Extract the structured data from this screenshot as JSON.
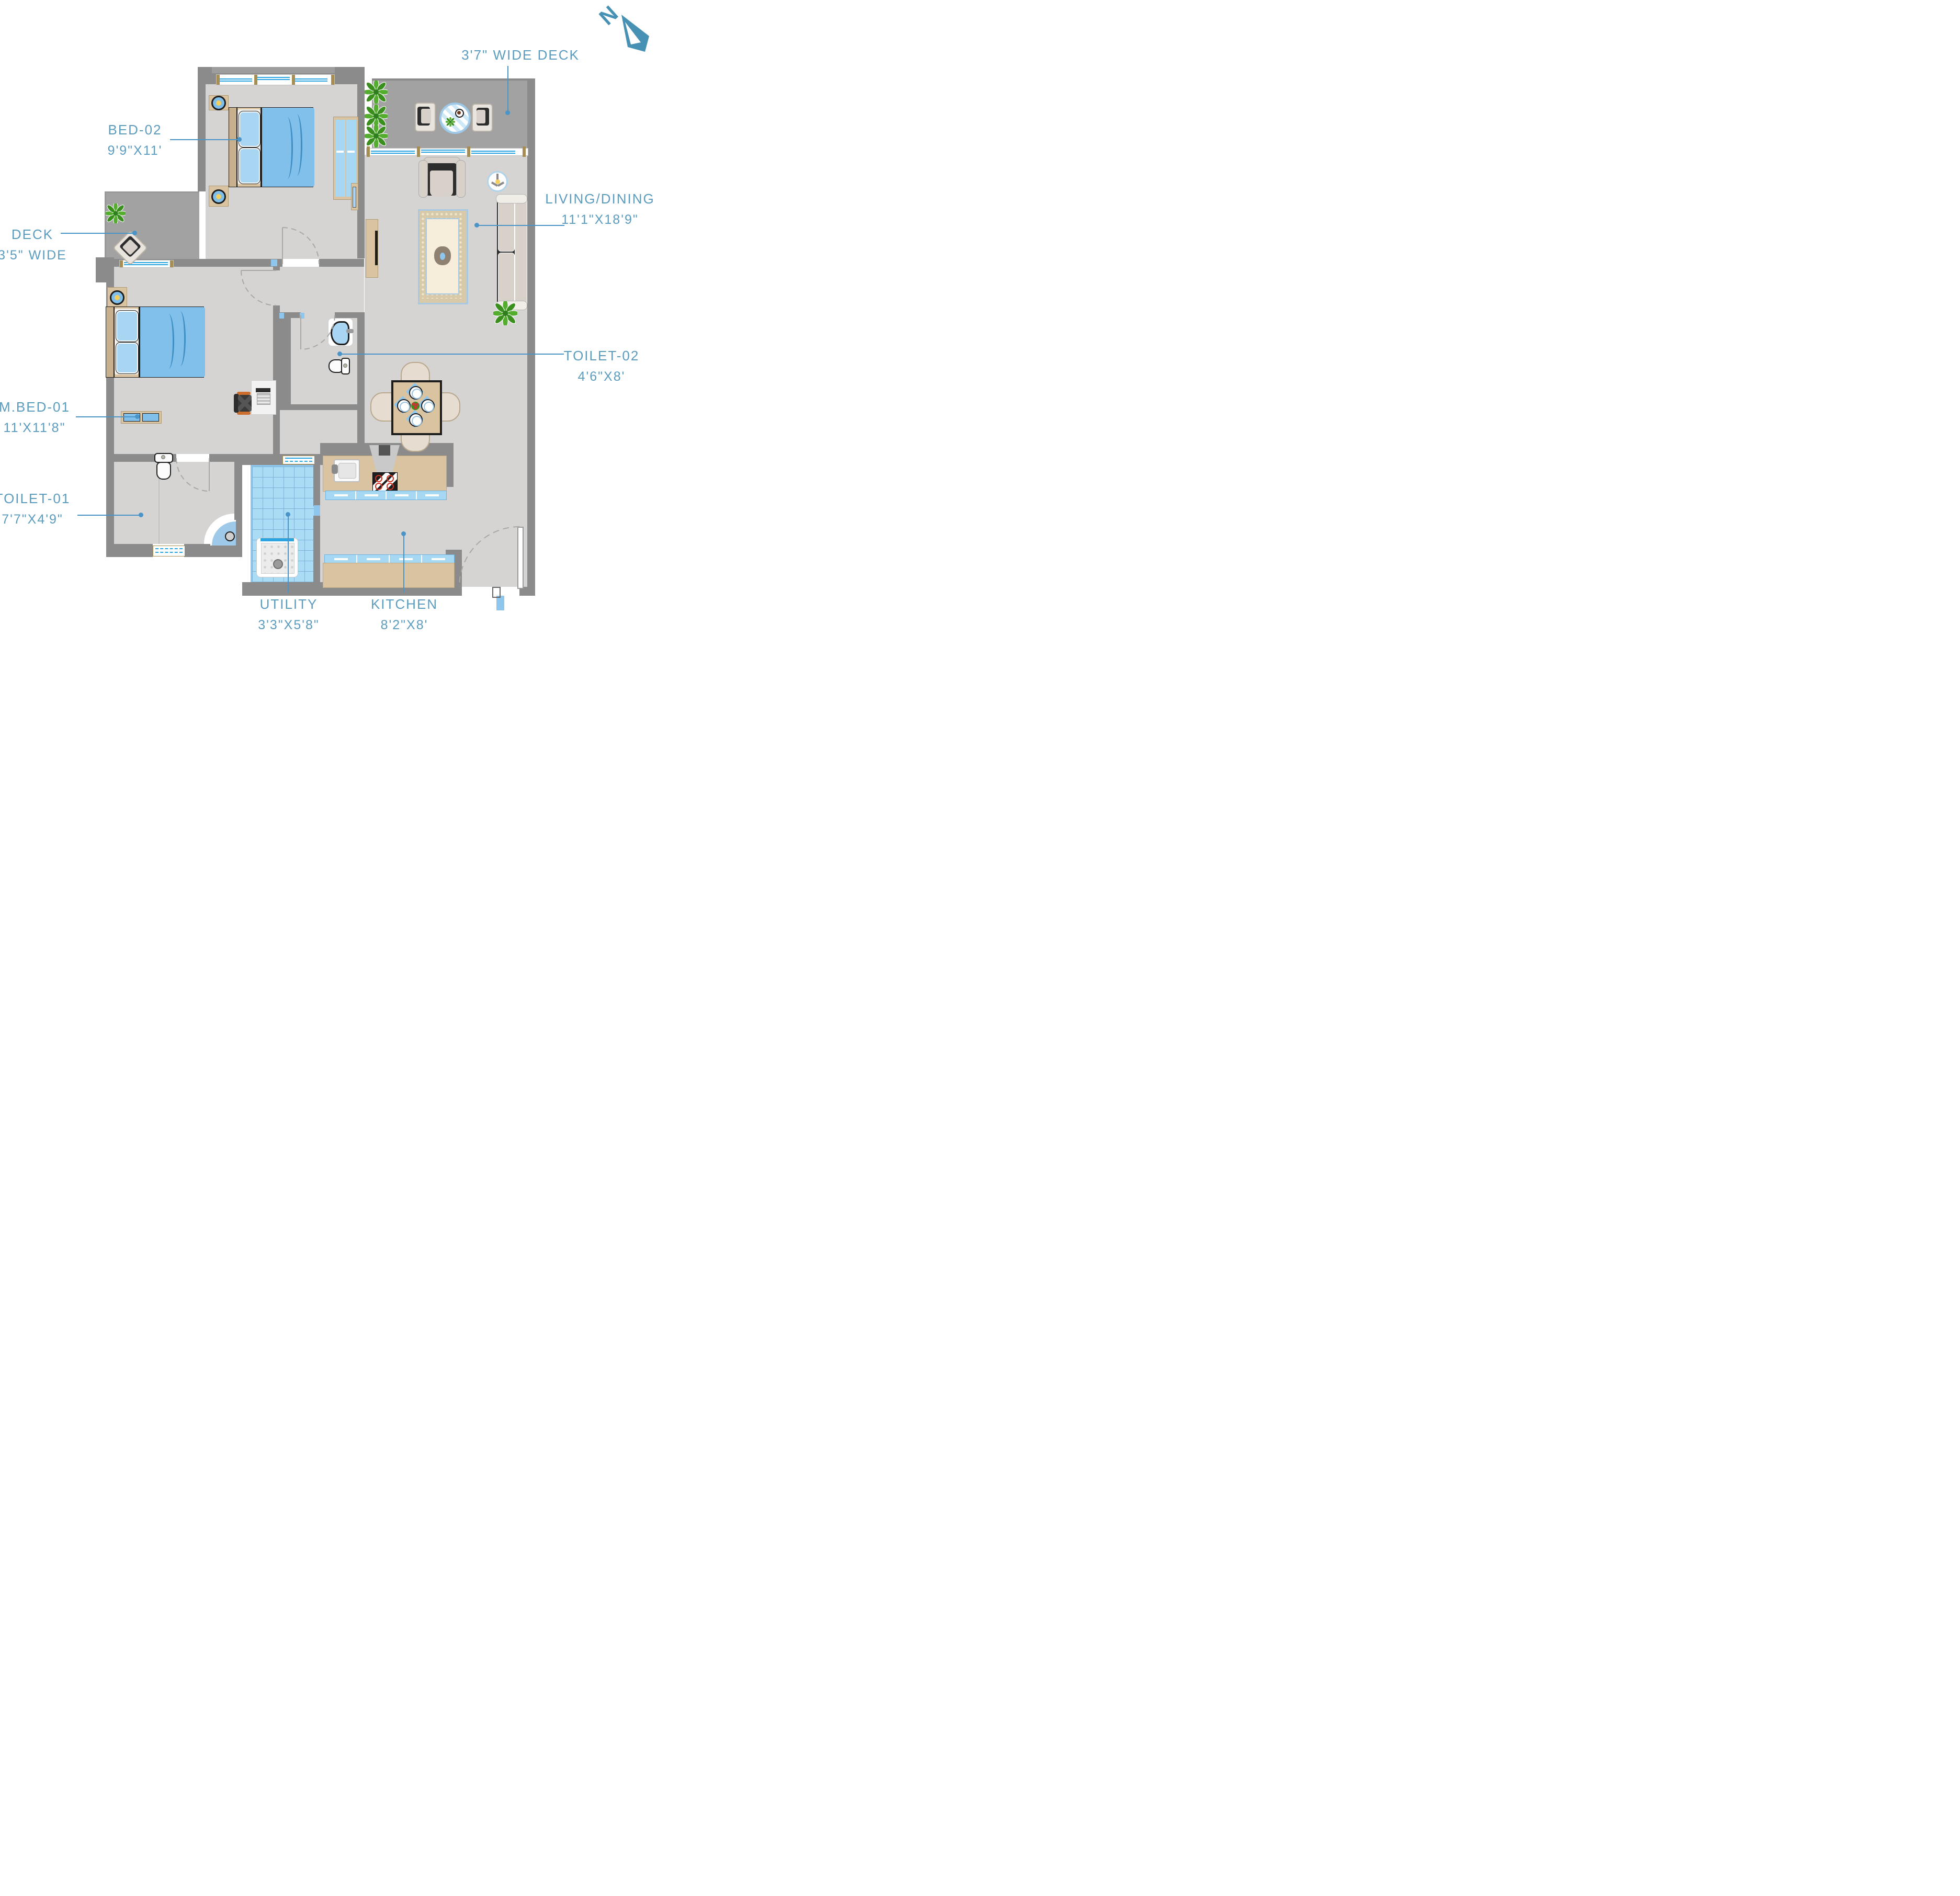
{
  "page": {
    "background": "#ffffff"
  },
  "north": {
    "letter": "N",
    "color": "#4792b4"
  },
  "accent": {
    "label_color": "#5b9cbf",
    "leader_color": "#4a94c8",
    "window_blue": "#2aa5e2",
    "wall_gray": "#8b8b8b"
  },
  "labels": {
    "deck_top": {
      "name": "3'7\" WIDE DECK"
    },
    "bed02": {
      "name": "BED-02",
      "dims": "9'9\"X11'"
    },
    "living": {
      "name": "LIVING/DINING",
      "dims": "11'1\"X18'9\""
    },
    "deck_left": {
      "name": "DECK",
      "dims": "3'5\" WIDE"
    },
    "mbed01": {
      "name": "M.BED-01",
      "dims": "11'X11'8\""
    },
    "toilet01": {
      "name": "TOILET-01",
      "dims": "7'7\"X4'9\""
    },
    "toilet02": {
      "name": "TOILET-02",
      "dims": "4'6\"X8'"
    },
    "utility": {
      "name": "UTILITY",
      "dims": "3'3\"X5'8\""
    },
    "kitchen": {
      "name": "KITCHEN",
      "dims": "8'2\"X8'"
    }
  }
}
